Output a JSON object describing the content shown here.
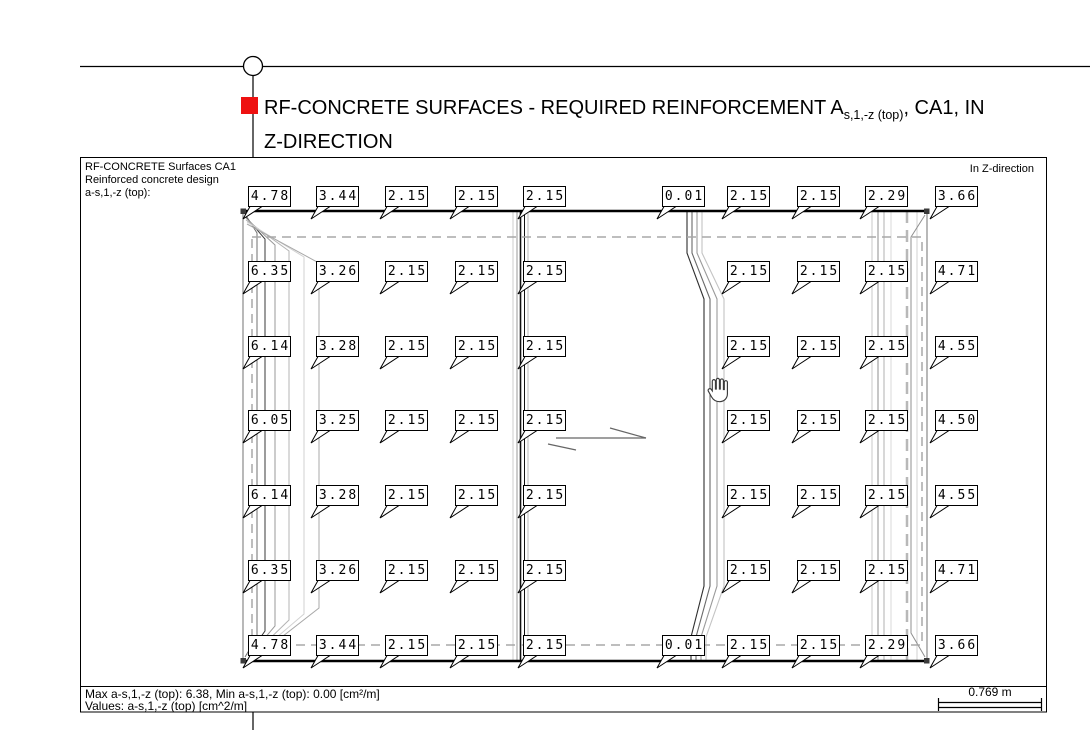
{
  "title": {
    "prefix": "RF-CONCRETE SURFACES - REQUIRED REINFORCEMENT A",
    "subscript": "s,1,-z (top)",
    "suffix": ", CA1, IN",
    "line2": "Z-DIRECTION"
  },
  "panel_header": {
    "line1": "RF-CONCRETE Surfaces CA1",
    "line2": "Reinforced concrete design",
    "line3": "a-s,1,-z (top):",
    "direction": "In Z-direction"
  },
  "footer": {
    "stats": "Max a-s,1,-z (top): 6.38, Min a-s,1,-z (top): 0.00 [cm²/m]",
    "values_caption": "Values: a-s,1,-z (top) [cm^2/m]",
    "scale": "0.769 m"
  },
  "colors": {
    "accent_red": "#ee1111"
  },
  "values": {
    "rows": [
      {
        "y": 186,
        "cells": [
          {
            "x": 248,
            "v": "4.78"
          },
          {
            "x": 316,
            "v": "3.44"
          },
          {
            "x": 385,
            "v": "2.15"
          },
          {
            "x": 455,
            "v": "2.15"
          },
          {
            "x": 523,
            "v": "2.15"
          },
          {
            "x": 662,
            "v": "0.01"
          },
          {
            "x": 727,
            "v": "2.15"
          },
          {
            "x": 797,
            "v": "2.15"
          },
          {
            "x": 865,
            "v": "2.29"
          },
          {
            "x": 935,
            "v": "3.66"
          }
        ]
      },
      {
        "y": 261,
        "cells": [
          {
            "x": 248,
            "v": "6.35"
          },
          {
            "x": 316,
            "v": "3.26"
          },
          {
            "x": 385,
            "v": "2.15"
          },
          {
            "x": 455,
            "v": "2.15"
          },
          {
            "x": 523,
            "v": "2.15"
          },
          {
            "x": 727,
            "v": "2.15"
          },
          {
            "x": 797,
            "v": "2.15"
          },
          {
            "x": 865,
            "v": "2.15"
          },
          {
            "x": 935,
            "v": "4.71"
          }
        ]
      },
      {
        "y": 336,
        "cells": [
          {
            "x": 248,
            "v": "6.14"
          },
          {
            "x": 316,
            "v": "3.28"
          },
          {
            "x": 385,
            "v": "2.15"
          },
          {
            "x": 455,
            "v": "2.15"
          },
          {
            "x": 523,
            "v": "2.15"
          },
          {
            "x": 727,
            "v": "2.15"
          },
          {
            "x": 797,
            "v": "2.15"
          },
          {
            "x": 865,
            "v": "2.15"
          },
          {
            "x": 935,
            "v": "4.55"
          }
        ]
      },
      {
        "y": 410,
        "cells": [
          {
            "x": 248,
            "v": "6.05"
          },
          {
            "x": 316,
            "v": "3.25"
          },
          {
            "x": 385,
            "v": "2.15"
          },
          {
            "x": 455,
            "v": "2.15"
          },
          {
            "x": 523,
            "v": "2.15"
          },
          {
            "x": 727,
            "v": "2.15"
          },
          {
            "x": 797,
            "v": "2.15"
          },
          {
            "x": 865,
            "v": "2.15"
          },
          {
            "x": 935,
            "v": "4.50"
          }
        ]
      },
      {
        "y": 485,
        "cells": [
          {
            "x": 248,
            "v": "6.14"
          },
          {
            "x": 316,
            "v": "3.28"
          },
          {
            "x": 385,
            "v": "2.15"
          },
          {
            "x": 455,
            "v": "2.15"
          },
          {
            "x": 523,
            "v": "2.15"
          },
          {
            "x": 727,
            "v": "2.15"
          },
          {
            "x": 797,
            "v": "2.15"
          },
          {
            "x": 865,
            "v": "2.15"
          },
          {
            "x": 935,
            "v": "4.55"
          }
        ]
      },
      {
        "y": 560,
        "cells": [
          {
            "x": 248,
            "v": "6.35"
          },
          {
            "x": 316,
            "v": "3.26"
          },
          {
            "x": 385,
            "v": "2.15"
          },
          {
            "x": 455,
            "v": "2.15"
          },
          {
            "x": 523,
            "v": "2.15"
          },
          {
            "x": 727,
            "v": "2.15"
          },
          {
            "x": 797,
            "v": "2.15"
          },
          {
            "x": 865,
            "v": "2.15"
          },
          {
            "x": 935,
            "v": "4.71"
          }
        ]
      },
      {
        "y": 635,
        "cells": [
          {
            "x": 248,
            "v": "4.78"
          },
          {
            "x": 316,
            "v": "3.44"
          },
          {
            "x": 385,
            "v": "2.15"
          },
          {
            "x": 455,
            "v": "2.15"
          },
          {
            "x": 523,
            "v": "2.15"
          },
          {
            "x": 662,
            "v": "0.01"
          },
          {
            "x": 727,
            "v": "2.15"
          },
          {
            "x": 797,
            "v": "2.15"
          },
          {
            "x": 865,
            "v": "2.29"
          },
          {
            "x": 935,
            "v": "3.66"
          }
        ]
      }
    ]
  }
}
